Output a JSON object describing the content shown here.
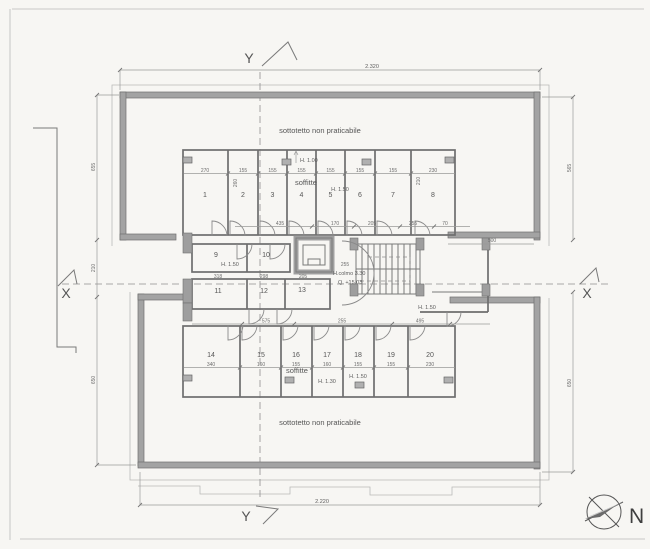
{
  "axes": {
    "y_top": "Y",
    "y_bottom": "Y",
    "x_left": "X",
    "x_right": "X"
  },
  "compass": {
    "label": "N"
  },
  "notes": {
    "attic_top": "sottotetto non praticabile",
    "attic_bottom": "sottotetto non praticabile"
  },
  "labels": {
    "soffitte_top": "soffitte",
    "soffitte_bottom": "soffitte",
    "h100": "H. 1.00",
    "h150_top": "H. 1.50",
    "h150_room9": "H. 1.50",
    "h150_right": "H. 1.50",
    "h150_room18": "H. 1.50",
    "h130": "H. 1.30",
    "ridge": "H.colmo 3.30",
    "elevation": "Q. +15.03"
  },
  "rooms": {
    "top": [
      "1",
      "2",
      "3",
      "4",
      "5",
      "6",
      "7",
      "8"
    ],
    "mid_upper": [
      "9",
      "10"
    ],
    "mid_lower": [
      "11",
      "12",
      "13"
    ],
    "bottom": [
      "14",
      "15",
      "16",
      "17",
      "18",
      "19",
      "20"
    ]
  },
  "dimensions": {
    "top_width": "2.320",
    "bottom_width": "2.220",
    "left": [
      "655",
      "210",
      "650"
    ],
    "right": [
      "565",
      "650"
    ],
    "top_rooms": [
      "270",
      "155",
      "155",
      "155",
      "155",
      "155",
      "155",
      "230"
    ],
    "corridor_top": [
      "435",
      "170",
      "205",
      "255",
      "70",
      "500"
    ],
    "mid": [
      "318",
      "298",
      "205",
      "255"
    ],
    "corridor_bottom": [
      "575",
      "255",
      "495"
    ],
    "bottom_rooms": [
      "340",
      "160",
      "155",
      "160",
      "155",
      "155",
      "230"
    ],
    "misc": [
      "260",
      "210"
    ]
  },
  "colors": {
    "paper": "#f7f6f3",
    "wall": "#a3a3a3",
    "line": "#6e6e6e"
  }
}
